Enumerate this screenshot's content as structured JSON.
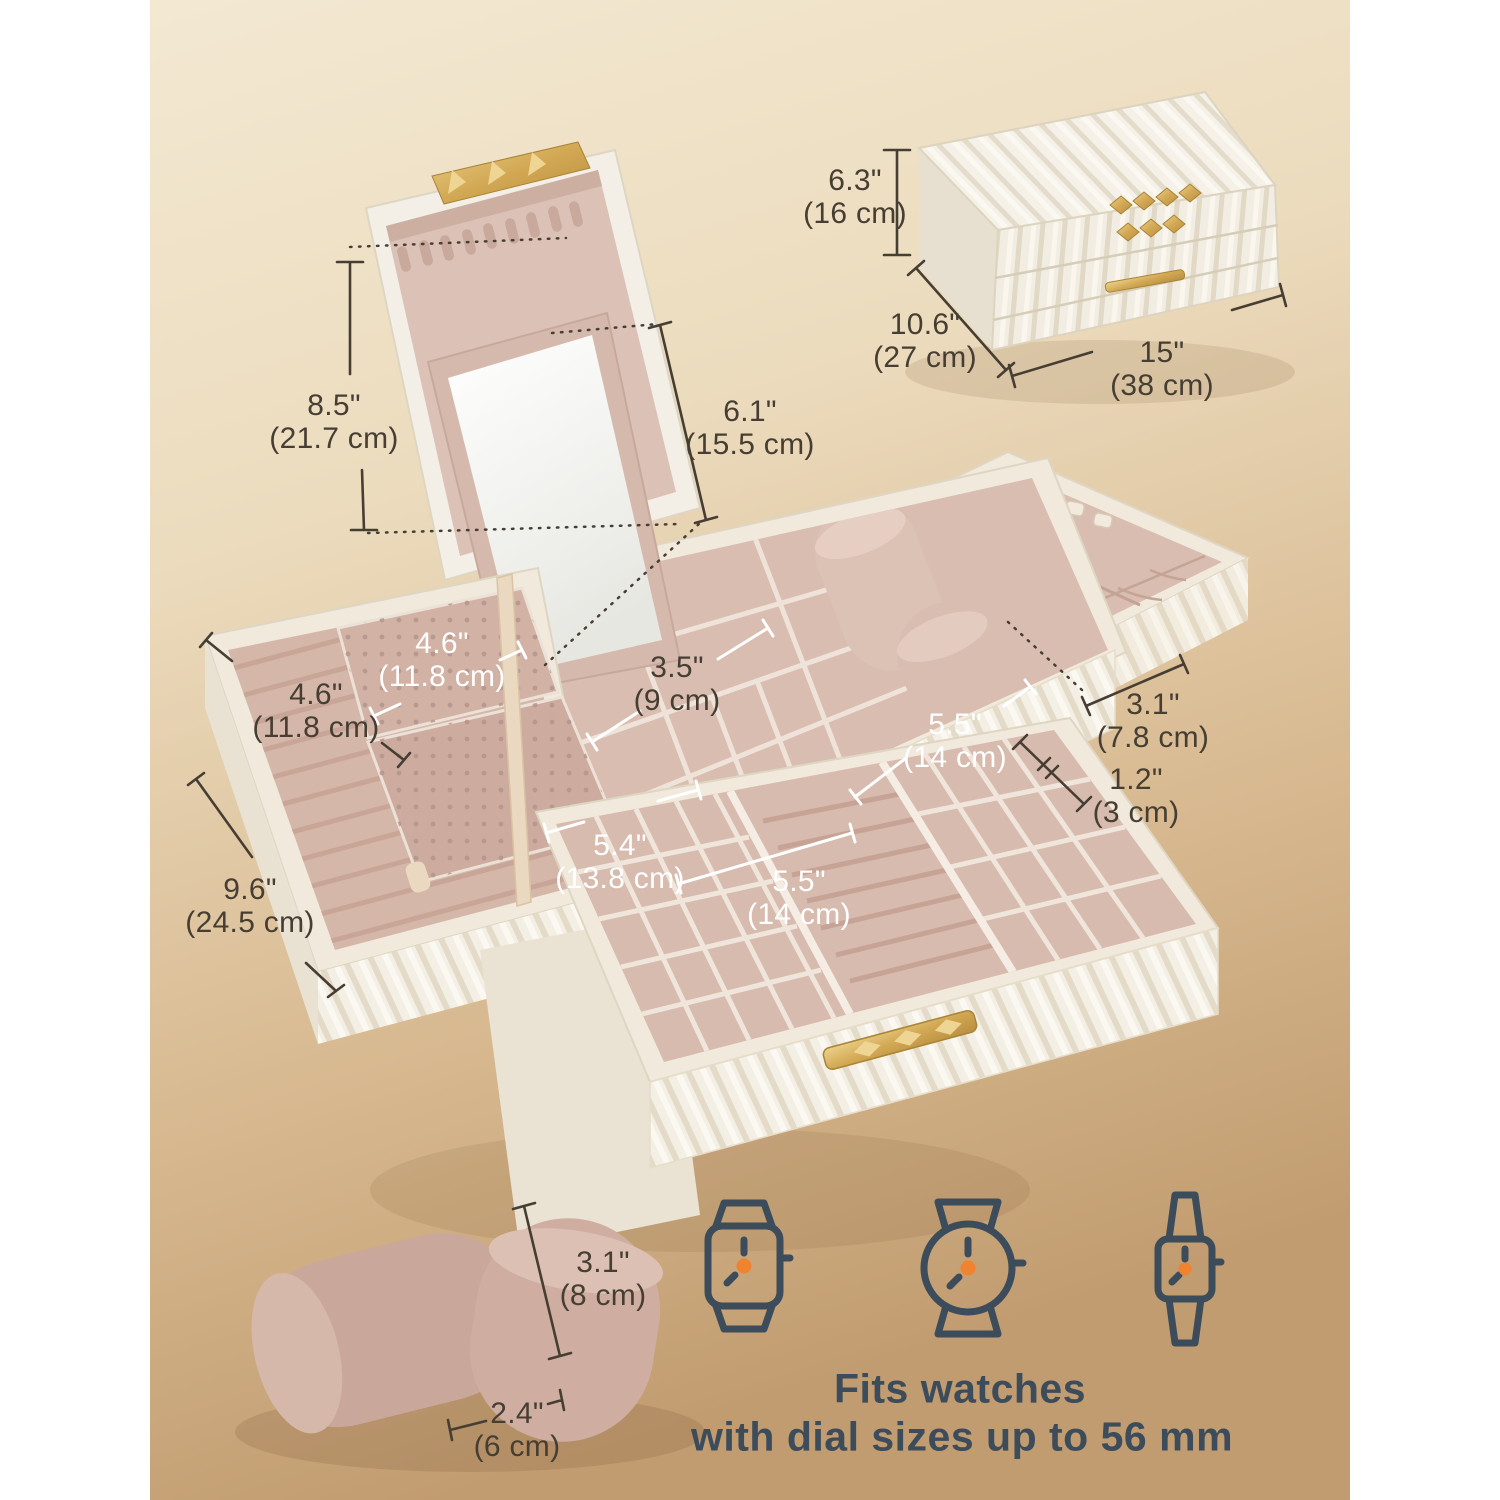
{
  "dimensions": {
    "closed_height": {
      "in": "6.3\"",
      "cm": "(16 cm)"
    },
    "closed_depth": {
      "in": "10.6\"",
      "cm": "(27 cm)"
    },
    "closed_width": {
      "in": "15\"",
      "cm": "(38 cm)"
    },
    "lid_height": {
      "in": "8.5\"",
      "cm": "(21.7 cm)"
    },
    "mirror_height": {
      "in": "6.1\"",
      "cm": "(15.5 cm)"
    },
    "earring_flap_width": {
      "in": "4.6\"",
      "cm": "(11.8 cm)"
    },
    "left_tray_width": {
      "in": "4.6\"",
      "cm": "(11.8 cm)"
    },
    "middle_compartment_width": {
      "in": "3.5\"",
      "cm": "(9 cm)"
    },
    "watch_area_width": {
      "in": "5.5\"",
      "cm": "(14 cm)"
    },
    "right_tray_depth": {
      "in": "3.1\"",
      "cm": "(7.8 cm)"
    },
    "gap_height": {
      "in": "1.2\"",
      "cm": "(3 cm)"
    },
    "drawer_left_width": {
      "in": "5.4\"",
      "cm": "(13.8 cm)"
    },
    "drawer_middle_width": {
      "in": "5.5\"",
      "cm": "(14 cm)"
    },
    "box_depth": {
      "in": "9.6\"",
      "cm": "(24.5 cm)"
    },
    "pillow_height": {
      "in": "3.1\"",
      "cm": "(8 cm)"
    },
    "pillow_diameter": {
      "in": "2.4\"",
      "cm": "(6 cm)"
    }
  },
  "caption": {
    "line1": "Fits watches",
    "line2": "with dial sizes up to 56 mm"
  },
  "icons": [
    "smartwatch-icon",
    "round-watch-icon",
    "square-watch-icon"
  ],
  "colors": {
    "ink": "#463e33",
    "navy": "#3c4c5a",
    "orange": "#ef8330",
    "gold": "#cfa14f",
    "velvet": "#d9bdb1"
  }
}
